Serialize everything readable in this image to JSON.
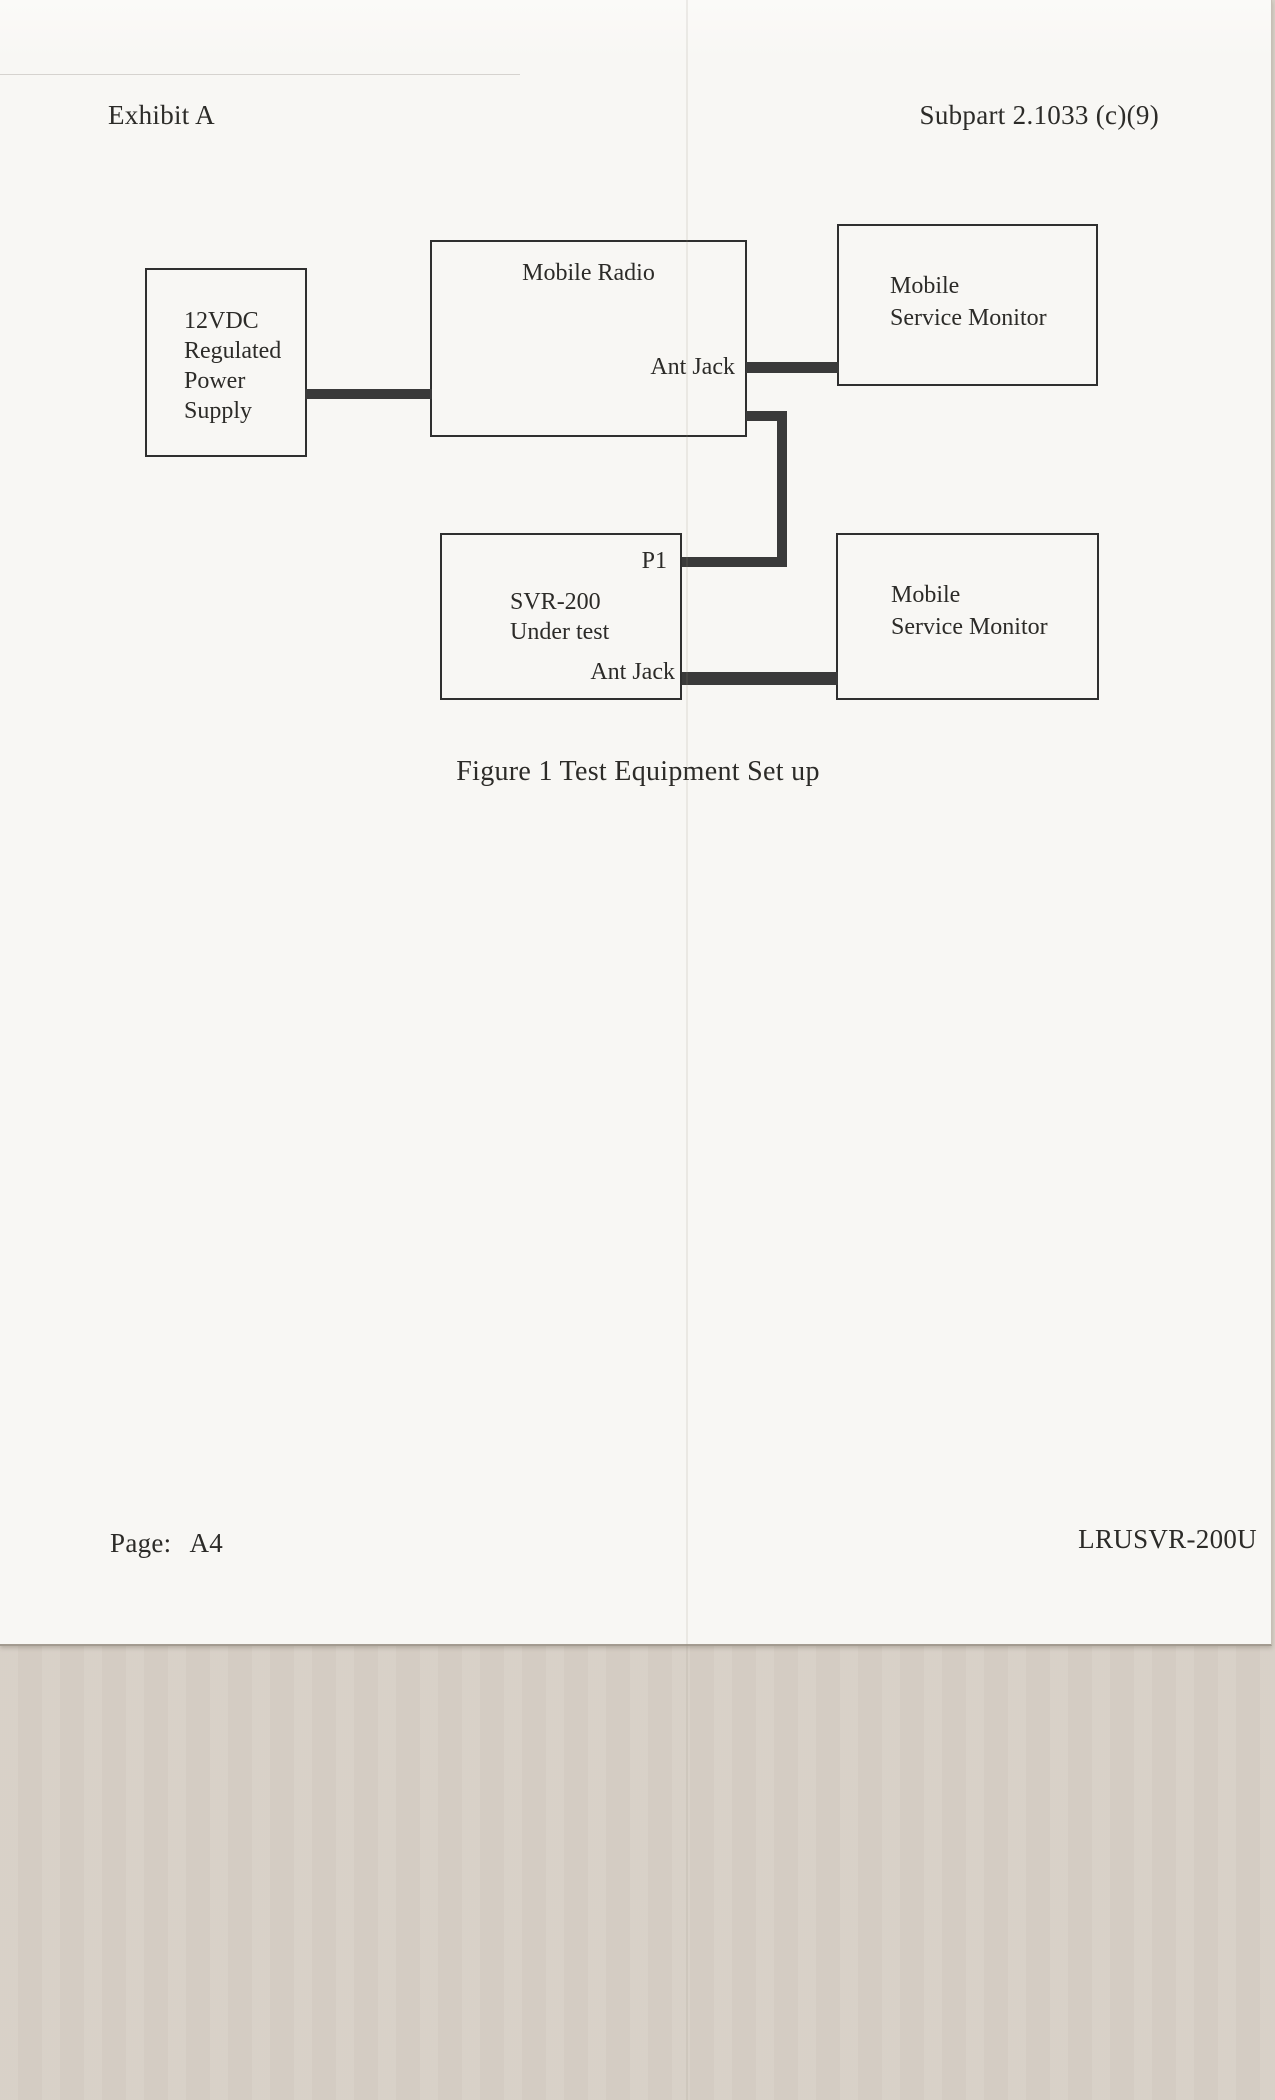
{
  "document": {
    "header": {
      "left": "Exhibit A",
      "right": "Subpart 2.1033 (c)(9)"
    },
    "figure_caption": "Figure 1 Test Equipment Set up",
    "footer": {
      "page_label": "Page:",
      "page_value": "A4",
      "doc_id": "LRUSVR-200U"
    }
  },
  "diagram": {
    "boxes": {
      "power_supply": {
        "lines": [
          "12VDC",
          "Regulated",
          "Power",
          "Supply"
        ]
      },
      "mobile_radio": {
        "title": "Mobile Radio",
        "port": "Ant Jack"
      },
      "monitor_top": {
        "lines": [
          "Mobile",
          "Service Monitor"
        ]
      },
      "svr_under_test": {
        "port_top": "P1",
        "lines": [
          "SVR-200",
          "Under test"
        ],
        "port_bottom": "Ant Jack"
      },
      "monitor_bottom": {
        "lines": [
          "Mobile",
          "Service Monitor"
        ]
      }
    }
  },
  "colors": {
    "connector": "#3a3a3a",
    "box_border": "#2f2f2f",
    "text": "#2c2b28",
    "page_bg": "#f8f7f4",
    "backing_bg": "#d7cfc6"
  }
}
